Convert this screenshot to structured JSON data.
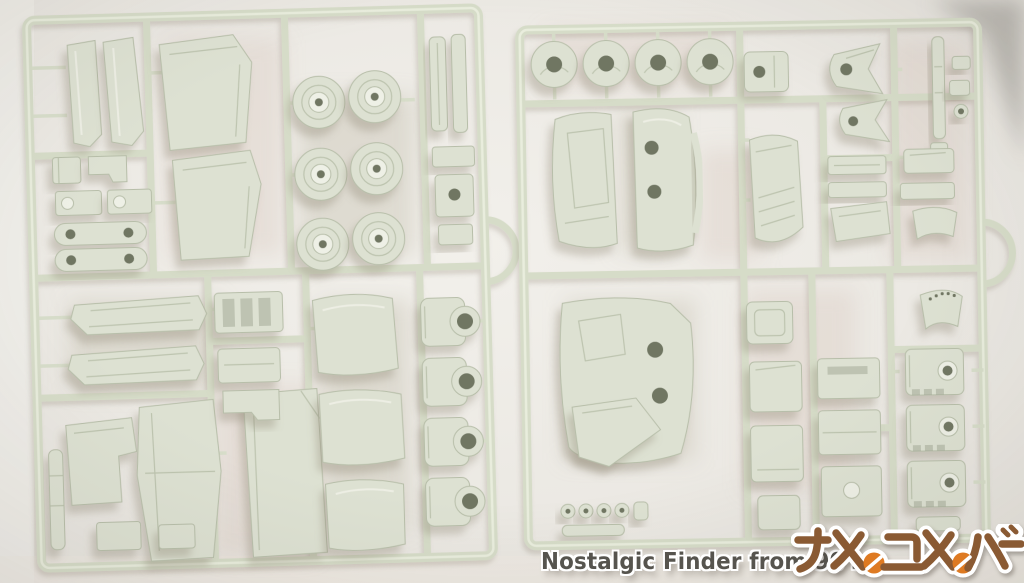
{
  "watermark": {
    "tagline": "Nostalgic Finder from 90's",
    "logo_text": "アメのユメのバー"
  },
  "colors": {
    "bg": "#eceae5",
    "bg-edge": "#e3e0da",
    "bg-dark-corner": "#b3b0aa",
    "plastic": "#dde1d2",
    "plastic-hi": "#eef0e6",
    "plastic-edge": "#b7bea9",
    "rail": "#d6dcc8",
    "rail-hi": "#ebeedf",
    "hole": "#99a08b",
    "hole-dark": "#707662",
    "shadow": "#8d8472",
    "tint-pink": "#dccdc4",
    "tint-gray": "#c6c0b1",
    "wm-text": "#56544e",
    "wm-outline": "#ffffff",
    "logo-brown": "#8a5a33",
    "logo-orange": "#de7a22"
  }
}
